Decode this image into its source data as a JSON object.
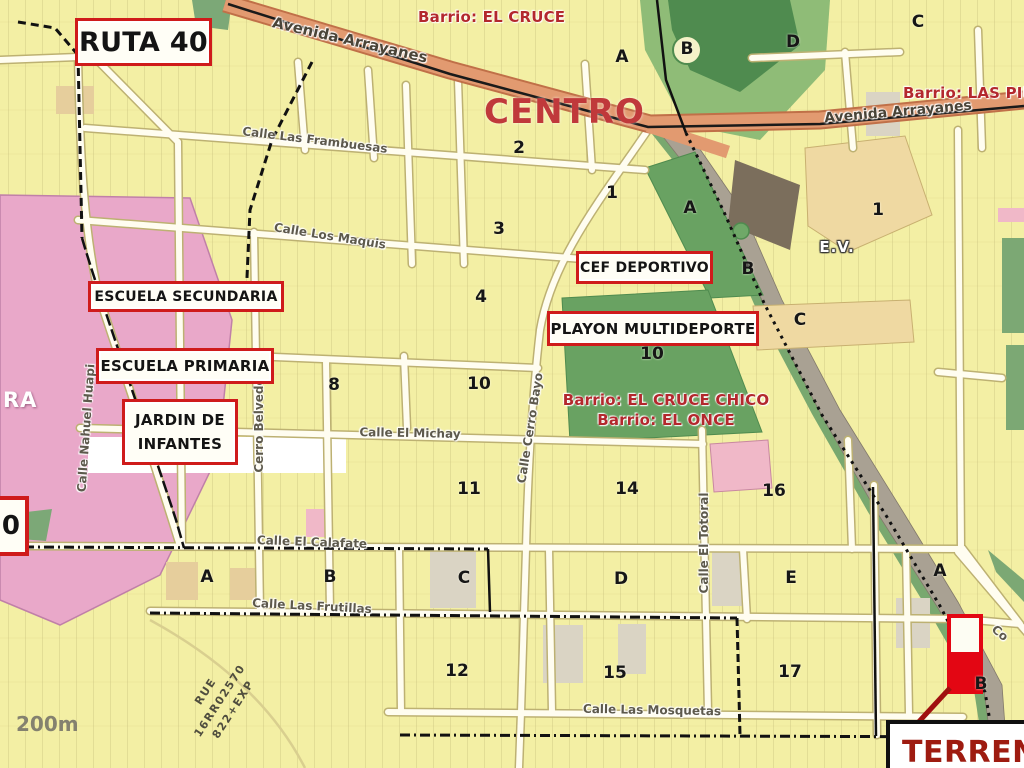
{
  "areas": {
    "centro": "CENTRO",
    "barrio_el_cruce": "Barrio: EL CRUCE",
    "barrio_las_piedritas": "Barrio: LAS PIEDRITAS",
    "barrio_el_cruce_chico": "Barrio: EL CRUCE CHICO",
    "barrio_el_once": "Barrio: EL ONCE",
    "ev": "E.V.",
    "ra": "RA",
    "terreno": "TERRENO"
  },
  "route_shields": [
    {
      "id": "ruta-40",
      "label": "RUTA 40"
    },
    {
      "id": "left-shield",
      "label": "0"
    }
  ],
  "landmarks": [
    {
      "id": "escuela-secundaria",
      "lines": [
        "ESCUELA SECUNDARIA"
      ]
    },
    {
      "id": "escuela-primaria",
      "lines": [
        "ESCUELA PRIMARIA"
      ]
    },
    {
      "id": "jardin-de-infantes",
      "lines": [
        "JARDIN DE",
        "INFANTES"
      ]
    },
    {
      "id": "cef-deportivo",
      "lines": [
        "CEF DEPORTIVO"
      ]
    },
    {
      "id": "playon-multideporte",
      "lines": [
        "PLAYON MULTIDEPORTE"
      ]
    }
  ],
  "streets": [
    {
      "t": "Avenida Arrayanes",
      "x": 350,
      "y": 40,
      "r": 13,
      "s": 15,
      "c": "avenue"
    },
    {
      "t": "Avenida Arrayanes",
      "x": 898,
      "y": 112,
      "r": -5,
      "s": 14,
      "c": "avenue"
    },
    {
      "t": "Calle Las Frambuesas",
      "x": 315,
      "y": 140,
      "r": 7,
      "s": 12,
      "c": ""
    },
    {
      "t": "Calle Los Maquis",
      "x": 330,
      "y": 236,
      "r": 9,
      "s": 12,
      "c": ""
    },
    {
      "t": "Calle El Michay",
      "x": 410,
      "y": 433,
      "r": 1,
      "s": 12,
      "c": ""
    },
    {
      "t": "Calle El Calafate",
      "x": 312,
      "y": 542,
      "r": 2,
      "s": 12,
      "c": ""
    },
    {
      "t": "Calle Las Frutillas",
      "x": 312,
      "y": 606,
      "r": 3,
      "s": 12,
      "c": ""
    },
    {
      "t": "Calle Las Mosquetas",
      "x": 652,
      "y": 710,
      "r": 1,
      "s": 12,
      "c": ""
    },
    {
      "t": "Calle Nahuel Huapi",
      "x": 86,
      "y": 428,
      "r": -86,
      "s": 12,
      "c": ""
    },
    {
      "t": "Cerro Belvedere",
      "x": 259,
      "y": 418,
      "r": -90,
      "s": 12,
      "c": ""
    },
    {
      "t": "Calle Cerro Bayo",
      "x": 530,
      "y": 428,
      "r": -81,
      "s": 12,
      "c": ""
    },
    {
      "t": "Calle El Totoral",
      "x": 704,
      "y": 543,
      "r": -90,
      "s": 12,
      "c": ""
    },
    {
      "t": "Co",
      "x": 1000,
      "y": 633,
      "r": 40,
      "s": 12,
      "c": ""
    }
  ],
  "blocks": [
    {
      "t": "A",
      "x": 622,
      "y": 57,
      "c": ""
    },
    {
      "t": "B",
      "x": 687,
      "y": 49,
      "c": ""
    },
    {
      "t": "D",
      "x": 793,
      "y": 42,
      "c": ""
    },
    {
      "t": "C",
      "x": 918,
      "y": 22,
      "c": ""
    },
    {
      "t": "2",
      "x": 519,
      "y": 148,
      "c": ""
    },
    {
      "t": "1",
      "x": 612,
      "y": 193,
      "c": ""
    },
    {
      "t": "3",
      "x": 499,
      "y": 229,
      "c": ""
    },
    {
      "t": "4",
      "x": 481,
      "y": 297,
      "c": ""
    },
    {
      "t": "A",
      "x": 690,
      "y": 208,
      "c": ""
    },
    {
      "t": "B",
      "x": 748,
      "y": 269,
      "c": ""
    },
    {
      "t": "C",
      "x": 800,
      "y": 320,
      "c": ""
    },
    {
      "t": "1",
      "x": 878,
      "y": 210,
      "c": ""
    },
    {
      "t": "8",
      "x": 334,
      "y": 385,
      "c": ""
    },
    {
      "t": "10",
      "x": 479,
      "y": 384,
      "c": ""
    },
    {
      "t": "10",
      "x": 652,
      "y": 354,
      "c": ""
    },
    {
      "t": "11",
      "x": 469,
      "y": 489,
      "c": ""
    },
    {
      "t": "14",
      "x": 627,
      "y": 489,
      "c": ""
    },
    {
      "t": "16",
      "x": 774,
      "y": 491,
      "c": ""
    },
    {
      "t": "A",
      "x": 207,
      "y": 577,
      "c": ""
    },
    {
      "t": "B",
      "x": 330,
      "y": 577,
      "c": ""
    },
    {
      "t": "C",
      "x": 464,
      "y": 578,
      "c": ""
    },
    {
      "t": "D",
      "x": 621,
      "y": 579,
      "c": ""
    },
    {
      "t": "E",
      "x": 791,
      "y": 578,
      "c": ""
    },
    {
      "t": "A",
      "x": 940,
      "y": 571,
      "c": ""
    },
    {
      "t": "12",
      "x": 457,
      "y": 671,
      "c": ""
    },
    {
      "t": "15",
      "x": 615,
      "y": 673,
      "c": ""
    },
    {
      "t": "17",
      "x": 790,
      "y": 672,
      "c": ""
    },
    {
      "t": "B",
      "x": 981,
      "y": 684,
      "c": ""
    },
    {
      "t": "E.V.",
      "x": 837,
      "y": 247,
      "c": "ev"
    }
  ],
  "watermark": [
    "RUE",
    "16RR02570",
    "822+EXP"
  ],
  "scale_text": "200m",
  "colors": {
    "background": "#F3EFA4",
    "avenue": "#E29A70",
    "green": "#69A262",
    "light_green": "#8FBC77",
    "pink_zone": "#E9A8C9",
    "stream_gray": "#A9A193",
    "landmark_border": "#CF1B1B",
    "barrio_text": "#B3282D",
    "terreno_red": "#E30613"
  }
}
